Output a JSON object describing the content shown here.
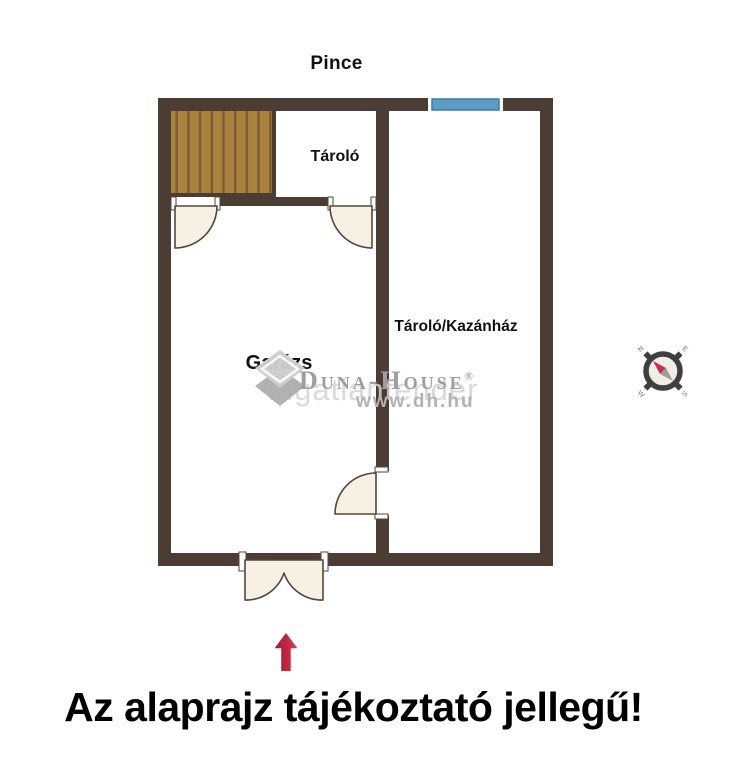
{
  "title": "Pince",
  "rooms": {
    "storage": "Tároló",
    "garage": "Garázs",
    "storage_boiler": "Tároló/Kazánház"
  },
  "watermark": {
    "brand": "Duna-House",
    "registered_mark": "®",
    "background_text": "ingatlantender",
    "website": "www.dh.hu"
  },
  "compass": {
    "north": "N",
    "east": "E",
    "south": "S",
    "west": "W"
  },
  "disclaimer": "Az alaprajz tájékoztató jellegű!",
  "colors": {
    "wall": "#4b3d33",
    "door-fill": "#f7f0e4",
    "door-stroke": "#55463c",
    "stair-plank": "#a9823f",
    "stair-stripe": "#7d5b2e",
    "window-fill": "#5b9dc6",
    "window-stroke": "#3a7ca8",
    "arrow-red": "#c22742",
    "needle-red": "#c53050",
    "wm-gray": "#9e9e9e",
    "wm-url": "#b2b2b2",
    "text-black": "#111111"
  }
}
